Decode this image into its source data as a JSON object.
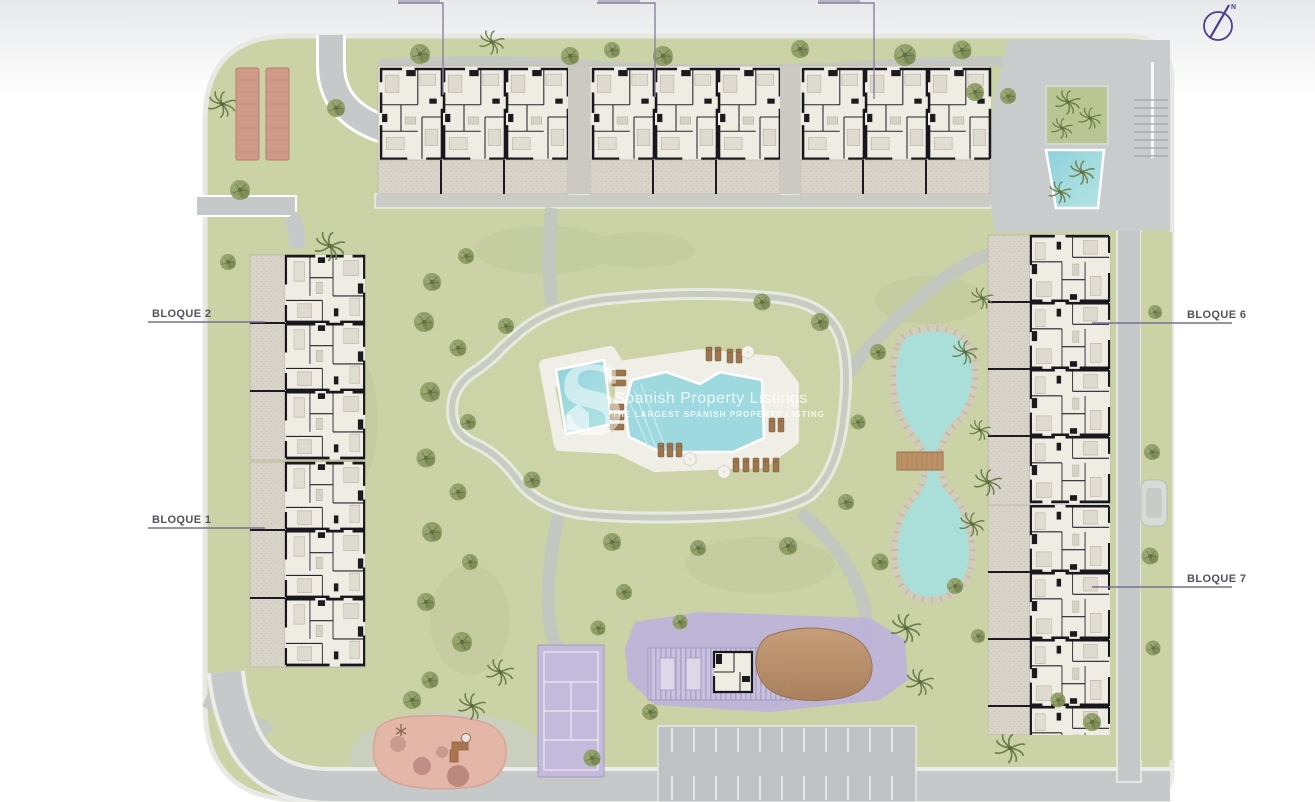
{
  "site_plan": {
    "labels": {
      "bloque1": "BLOQUE 1",
      "bloque2": "BLOQUE 2",
      "bloque6": "BLOQUE 6",
      "bloque7": "BLOQUE 7"
    },
    "compass": {
      "north": "N"
    },
    "watermark": {
      "logo_letter": "S",
      "title": "Spanish Property Listings",
      "subtitle": "THE LARGEST SPANISH PROPERTY LISTING"
    },
    "colors": {
      "grass": "#cad2a6",
      "mound_grass": "#ccd4a7",
      "road": "#c6c9ca",
      "path": "#c3c7c0",
      "building_fill": "#eeebe3",
      "wall": "#17171c",
      "terrace": "#d9d4ca",
      "pool_water": "#9ed9e0",
      "lake_water": "#aadfd9",
      "stone_rim": "#d2ccba",
      "court_purple": "#c4badb",
      "communal_purple": "#beb3d8",
      "playground_pink": "#e3b6a7",
      "wood_brown": "#b98e68",
      "pergola_brown": "#cf9a87",
      "label_line": "#7c6f91",
      "label_text": "#55525c",
      "compass_purple": "#4f3a8e",
      "watermark_white": "#ffffff"
    }
  }
}
